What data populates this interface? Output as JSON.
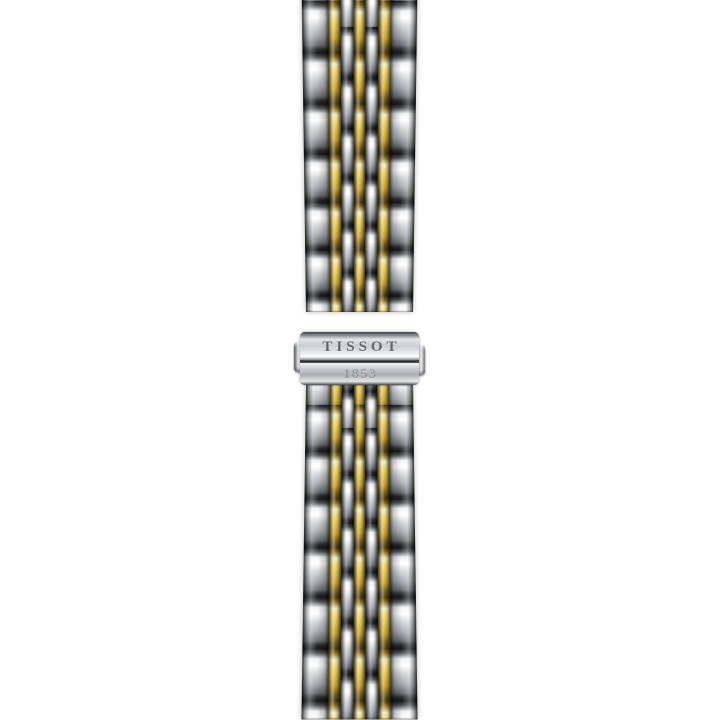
{
  "image": {
    "type": "product-photo",
    "subject": "Two-tone stainless steel and yellow gold multi-link watch bracelet shown vertically with a butterfly deployant clasp",
    "brand": "TISSOT"
  },
  "clasp": {
    "brand_engraving": "TISSOT",
    "year_engraving": "1853"
  },
  "colors": {
    "background": "#ffffff",
    "steel_highlight": "#ffffff",
    "steel_mid": "#a7abb0",
    "steel_dark": "#17181a",
    "gold_highlight": "#f6ebb4",
    "gold_light": "#f0d468",
    "gold_mid": "#d9b93e",
    "gold_deep": "#8a6d1a",
    "gold_dark": "#4a3a0c",
    "engraving": "#63666a",
    "year_engraving": "#7e8287",
    "clasp_seam": "#2b2d2f"
  }
}
